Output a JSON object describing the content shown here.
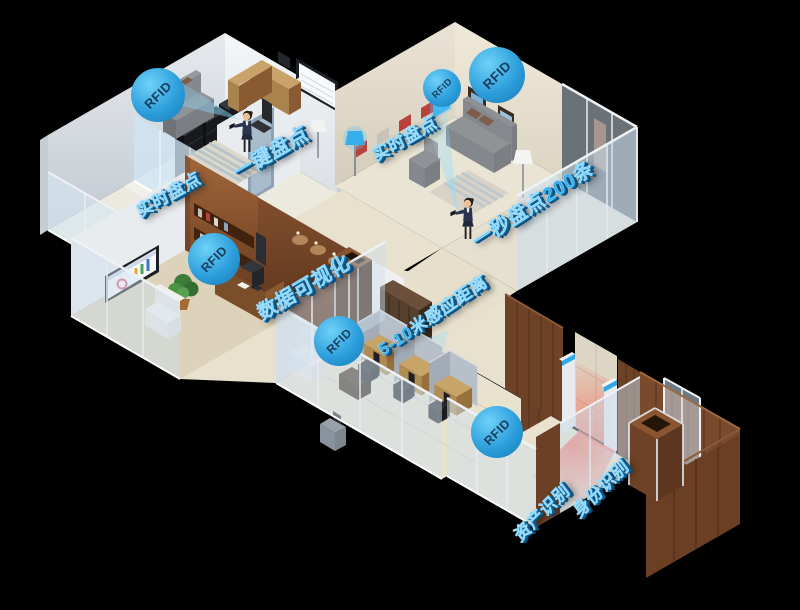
{
  "labels": {
    "rfid": "RFID",
    "realtime_inventory_left": "实时盘点",
    "one_key_inventory": "一键盘点",
    "realtime_inventory_right": "实时盘点",
    "one_second_inventory": "一秒盘点200条",
    "data_visualization": "数据可视化",
    "sensing_distance": "5-10米感应距离",
    "asset_identification": "资产识别",
    "identity_identification": "身份识别"
  },
  "colors": {
    "label_blue": "#2fb1f2",
    "badge_blue": "#2aa6e2",
    "badge_text": "#1a3e5e",
    "beam_red": "#ff3220",
    "scan_cone_blue": "#7dd4fc",
    "wood_brown": "#7a4a2c",
    "floor_beige": "#e9e2cf",
    "wall_white": "#e8eaec",
    "glass_blue": "#cfe0ee",
    "background": "#000000"
  }
}
